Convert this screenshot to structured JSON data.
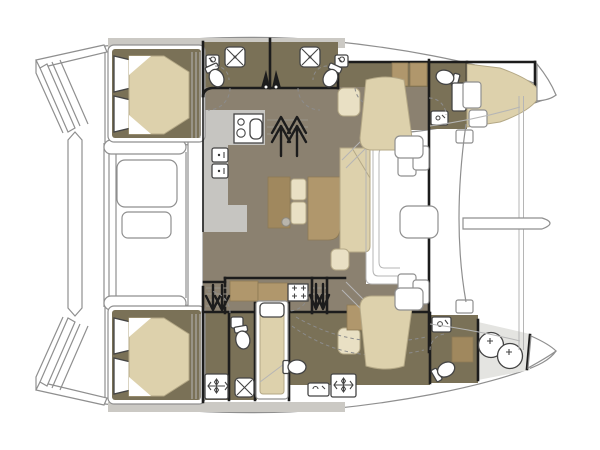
{
  "meta": {
    "label": "Catamaran interior layout floor plan, top-down view, bow to the right",
    "diagram_type": "boat-floorplan",
    "orientation": "bow-right"
  },
  "colors": {
    "background": "#ffffff",
    "outline": "#8f8f8f",
    "thin_line": "#b5b5b5",
    "wall": "#1c1c1c",
    "salon_floor": "#8b8170",
    "hull_floor": "#7a7157",
    "galley_floor": "#c6c5c1",
    "deck_gray": "#cbc9c4",
    "shower_floor": "#e4e4e1",
    "mattress": "#ddd1ac",
    "beige_stroke": "#b4a886",
    "cushion": "#e9e0c4",
    "wood": "#b0976c",
    "wood_dark": "#a0885e",
    "wood_edge": "#8d7a55",
    "fixture_stroke": "#444444",
    "door_dash": "#8c8c8c"
  },
  "rooms": [
    {
      "id": "aft-cockpit",
      "name": "Aft cockpit with table"
    },
    {
      "id": "salon",
      "name": "Salon / bridgedeck"
    },
    {
      "id": "galley",
      "name": "Galley with stove, sink and fridge"
    },
    {
      "id": "dinette",
      "name": "Dinette table with sofa"
    },
    {
      "id": "forward-cockpit",
      "name": "Forward cockpit with table and seats"
    },
    {
      "id": "foredeck",
      "name": "Foredeck with trampoline, bowsprit and crossbeam"
    },
    {
      "id": "port-aft-cabin",
      "name": "Port aft double cabin"
    },
    {
      "id": "port-aft-head",
      "name": "Port head with shower and toilet"
    },
    {
      "id": "port-second-head",
      "name": "Second head with shower and toilet"
    },
    {
      "id": "port-forward-head",
      "name": "Port forward head"
    },
    {
      "id": "port-bow-berth",
      "name": "Port bow berth"
    },
    {
      "id": "starboard-aft-cabin",
      "name": "Starboard aft double cabin"
    },
    {
      "id": "starboard-aft-head",
      "name": "Starboard aft head with shower and toilet"
    },
    {
      "id": "starboard-mid-berth",
      "name": "Starboard single berth"
    },
    {
      "id": "starboard-forward-cabin",
      "name": "Starboard forward cabin"
    },
    {
      "id": "starboard-forward-head",
      "name": "Starboard forward head"
    },
    {
      "id": "starboard-bow-shower",
      "name": "Bow shower compartment with twin basins"
    }
  ],
  "fixtures": [
    "toilet",
    "shower-tray",
    "shower-basin",
    "wash-basin",
    "stove-and-sink",
    "fridge",
    "cockpit-table",
    "dinette-table",
    "lounge-seat",
    "companionway-stairs",
    "mast-step",
    "deck-hatch",
    "double-berth",
    "single-berth",
    "bowsprit",
    "crossbeam"
  ]
}
